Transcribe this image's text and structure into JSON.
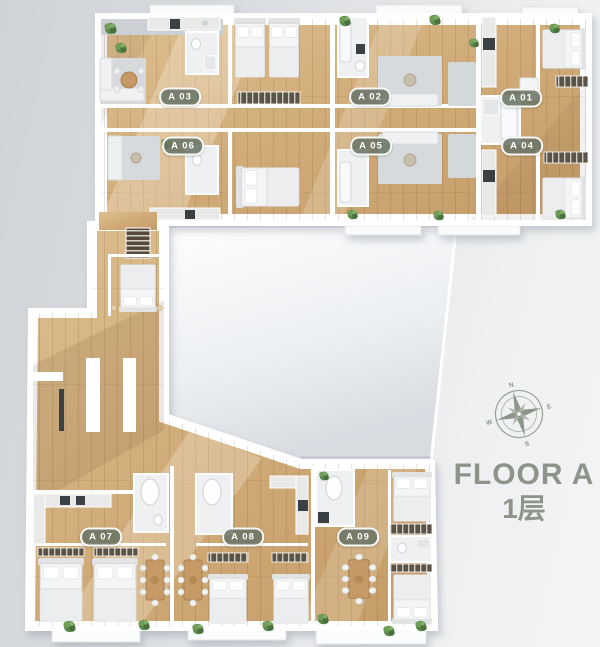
{
  "title": {
    "line1": "FLOOR A",
    "line2": "1层"
  },
  "units": [
    {
      "label": "A 03"
    },
    {
      "label": "A 02"
    },
    {
      "label": "A 01"
    },
    {
      "label": "A 06"
    },
    {
      "label": "A 05"
    },
    {
      "label": "A 04"
    },
    {
      "label": "A 07"
    },
    {
      "label": "A 08"
    },
    {
      "label": "A 09"
    }
  ],
  "compass": {
    "n": "N",
    "e": "E",
    "s": "S",
    "w": "W"
  },
  "colors": {
    "background_left": "#cfd3d7",
    "background_right": "#f3f4f5",
    "wood_floor": "#cfa976",
    "wall": "#ffffff",
    "roof_terrace": "#e3e7ea",
    "unit_badge": "#6a7465",
    "title_text": "#8f948a",
    "plant_green": "#5d8a4e"
  }
}
